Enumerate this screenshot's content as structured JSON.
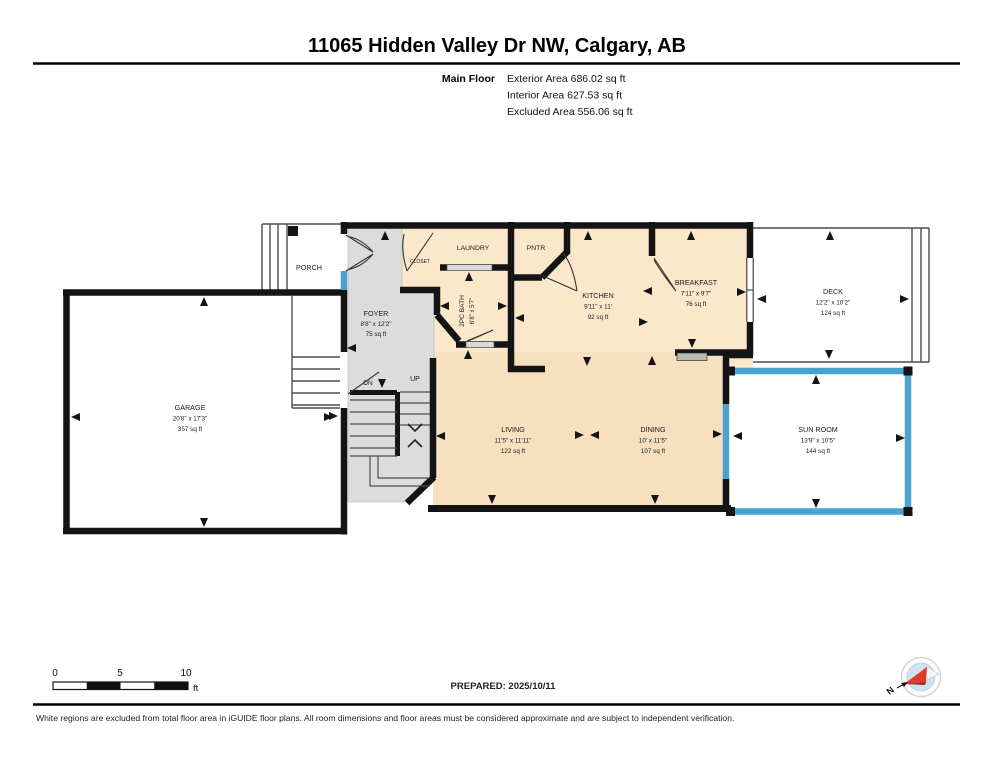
{
  "header": {
    "title": "11065 Hidden Valley Dr NW, Calgary, AB",
    "floor_label": "Main Floor",
    "stat_exterior": "Exterior Area 686.02 sq ft",
    "stat_interior": "Interior Area 627.53 sq ft",
    "stat_excluded": "Excluded Area 556.06 sq ft"
  },
  "rooms": {
    "porch": {
      "name": "PORCH"
    },
    "foyer": {
      "name": "FOYER",
      "dims": "8'8\" x 12'2\"",
      "area": "75 sq ft"
    },
    "closet": {
      "name": "CLOSET"
    },
    "laundry": {
      "name": "LAUNDRY"
    },
    "pantry": {
      "name": "PNTR"
    },
    "bath": {
      "name": "2PC BATH",
      "dims": "6'8\" x 5'7\""
    },
    "kitchen": {
      "name": "KITCHEN",
      "dims": "9'11\" x 11'",
      "area": "92 sq ft"
    },
    "breakfast": {
      "name": "BREAKFAST",
      "dims": "7'11\" x 9'7\"",
      "area": "76 sq ft"
    },
    "deck": {
      "name": "DECK",
      "dims": "12'2\" x 10'2\"",
      "area": "124 sq ft"
    },
    "garage": {
      "name": "GARAGE",
      "dims": "20'8\" x 17'3\"",
      "area": "357 sq ft"
    },
    "living": {
      "name": "LIVING",
      "dims": "11'5\" x 11'11\"",
      "area": "122 sq ft"
    },
    "dining": {
      "name": "DINING",
      "dims": "10' x 11'5\"",
      "area": "107 sq ft"
    },
    "sunroom": {
      "name": "SUN ROOM",
      "dims": "13'9\" x 10'5\"",
      "area": "144 sq ft"
    }
  },
  "stairs": {
    "up_label": "UP",
    "dn_label": "DN"
  },
  "scale_bar": {
    "tick0": "0",
    "tick1": "5",
    "tick2": "10",
    "unit": "ft"
  },
  "compass": {
    "north_label": "N"
  },
  "footer": {
    "prepared": "PREPARED: 2025/10/11",
    "disclaimer": "White regions are excluded from total floor area in iGUIDE floor plans. All room dimensions and floor areas must be considered approximate and are subject to independent verification."
  },
  "colors": {
    "wall": "#141414",
    "room_fill_upper": "#fbe8cb",
    "room_fill_lower": "#f6e0bf",
    "excluded_gray": "#dcdcdc",
    "window_blue": "#4ba2cf",
    "opening_gray": "#d9d9d9",
    "compass_red": "#e0392e"
  }
}
